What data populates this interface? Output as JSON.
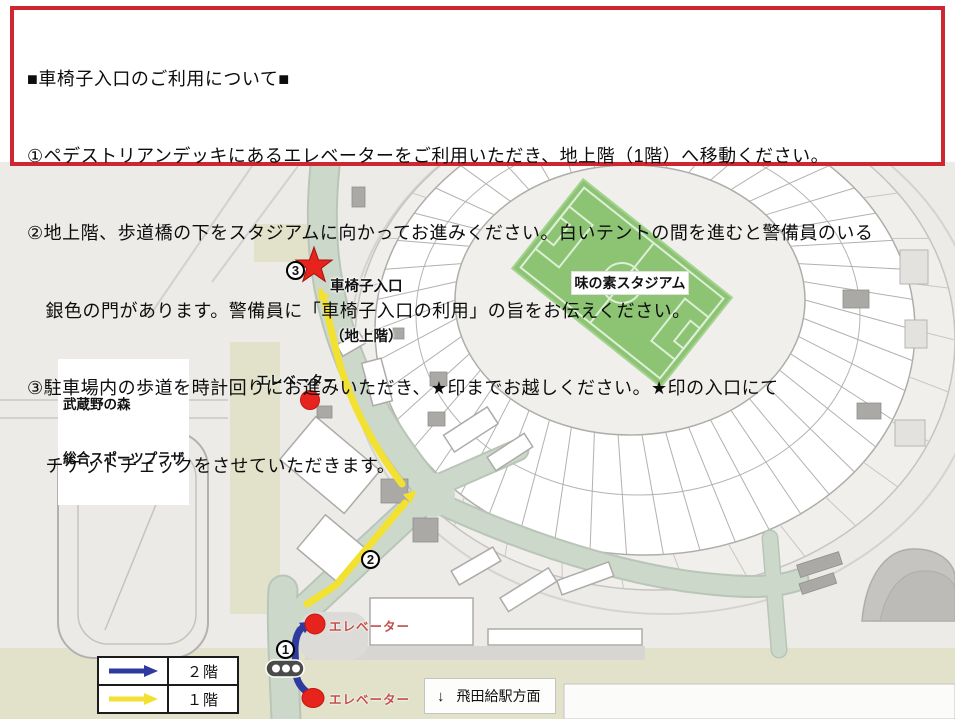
{
  "notice": {
    "title": "■車椅子入口のご利用について■",
    "lines": [
      "①ペデストリアンデッキにあるエレベーターをご利用いただき、地上階（1階）へ移動ください。",
      "②地上階、歩道橋の下をスタジアムに向かってお進みください。白いテントの間を進むと警備員のいる",
      "　銀色の門があります。警備員に「車椅子入口の利用」の旨をお伝えください。",
      "③駐車場内の歩道を時計回りにお進みいただき、★印までお越しください。★印の入口にて",
      "　チケットチェックをさせていただきます。"
    ]
  },
  "map": {
    "stadium_label": "味の素スタジアム",
    "plaza_label": {
      "line1": "武蔵野の森",
      "line2": "総合スポーツプラザ"
    },
    "entrance_label": {
      "line1": "車椅子入口",
      "line2": "（地上階）"
    },
    "elevator_label": "エレベーター",
    "station_direction": {
      "arrow": "↓",
      "text": "飛田給駅方面"
    },
    "legend": {
      "floor2": "２階",
      "floor1": "１階"
    },
    "steps": {
      "s1": "1",
      "s2": "2",
      "s3": "3"
    }
  },
  "colors": {
    "header_border": "#cf2732",
    "route_1f_yellow": "#f2e130",
    "route_2f_blue": "#2e3a9e",
    "elevator_red": "#e6231d",
    "star_red": "#e6231d",
    "elevator_label_red": "#c2504b",
    "field_green": "#8cc474",
    "road_green": "#ccd8ca",
    "grass_olive": "#e1e2c9"
  }
}
